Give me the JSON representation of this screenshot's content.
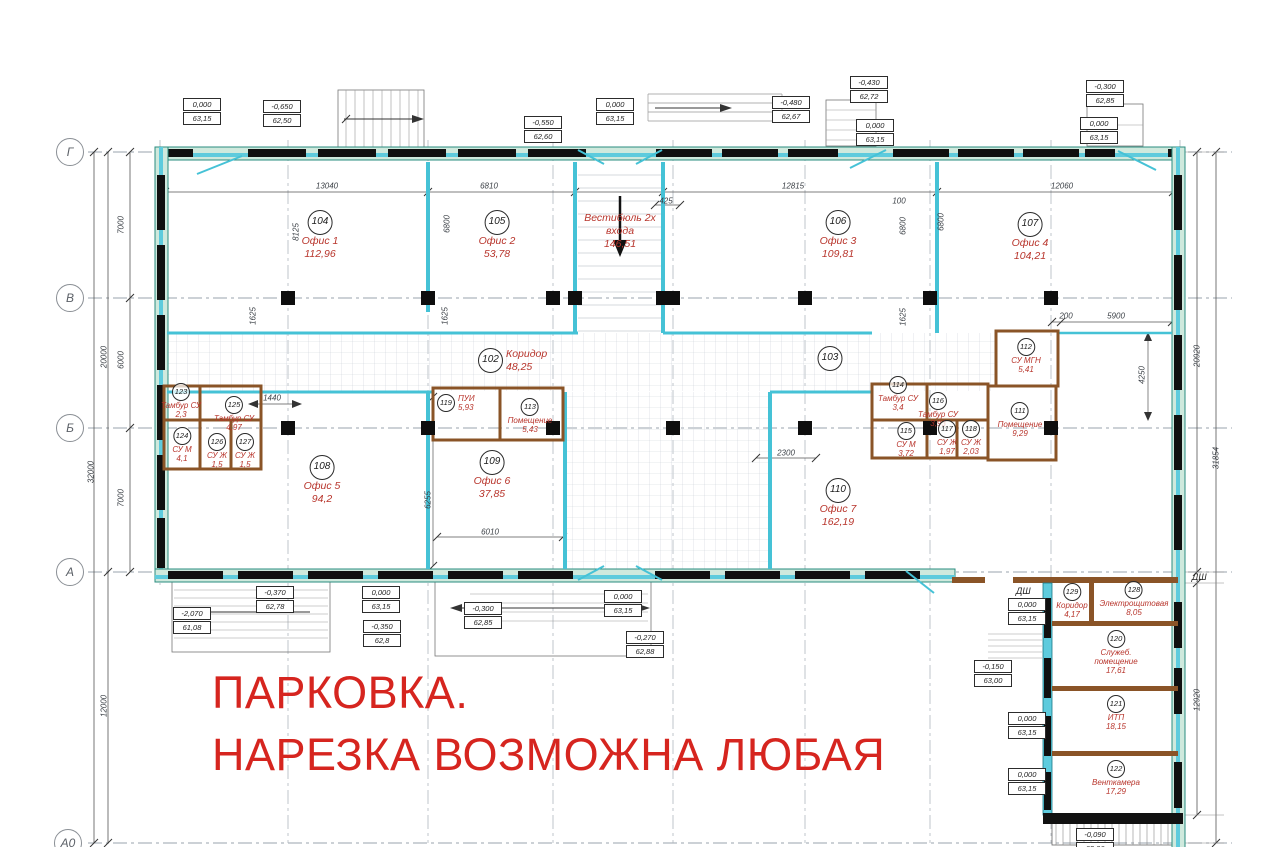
{
  "drawing": {
    "parking_note_line1": "ПАРКОВКА.",
    "parking_note_line2": "НАРЕЗКА ВОЗМОЖНА ЛЮБАЯ"
  },
  "colors": {
    "wall_cyan": "#5ecbdd",
    "wall_teal_outline": "#2a8c7f",
    "partition_brown": "#8a5427",
    "room_label_red": "#b8352c",
    "parking_red": "#d6251f"
  },
  "grid_bubbles": [
    {
      "label": "Г",
      "x": 70,
      "y": 152
    },
    {
      "label": "В",
      "x": 70,
      "y": 298
    },
    {
      "label": "Б",
      "x": 70,
      "y": 428
    },
    {
      "label": "А",
      "x": 70,
      "y": 572
    },
    {
      "label": "А0",
      "x": 68,
      "y": 843
    }
  ],
  "rooms": [
    {
      "num": "104",
      "name": "Офис 1",
      "area": "112,96",
      "x": 320,
      "y": 210,
      "size": "lg",
      "layout": "stack"
    },
    {
      "num": "105",
      "name": "Офис 2",
      "area": "53,78",
      "x": 497,
      "y": 210,
      "size": "lg",
      "layout": "stack"
    },
    {
      "num": "",
      "name": "Вестибюль 2х|входа",
      "area": "146,51",
      "x": 620,
      "y": 212,
      "size": "lg",
      "layout": "stack"
    },
    {
      "num": "106",
      "name": "Офис 3",
      "area": "109,81",
      "x": 838,
      "y": 210,
      "size": "lg",
      "layout": "stack"
    },
    {
      "num": "107",
      "name": "Офис 4",
      "area": "104,21",
      "x": 1030,
      "y": 212,
      "size": "lg",
      "layout": "stack"
    },
    {
      "num": "102",
      "name": "Коридор",
      "area": "48,25",
      "x": 478,
      "y": 348,
      "size": "lg",
      "layout": "inline"
    },
    {
      "num": "103",
      "name": "",
      "area": "",
      "x": 830,
      "y": 346,
      "size": "lg",
      "layout": "stack"
    },
    {
      "num": "108",
      "name": "Офис 5",
      "area": "94,2",
      "x": 322,
      "y": 455,
      "size": "lg",
      "layout": "stack"
    },
    {
      "num": "109",
      "name": "Офис 6",
      "area": "37,85",
      "x": 492,
      "y": 450,
      "size": "lg",
      "layout": "stack"
    },
    {
      "num": "110",
      "name": "Офис 7",
      "area": "162,19",
      "x": 838,
      "y": 478,
      "size": "lg",
      "layout": "stack"
    },
    {
      "num": "123",
      "name": "Тамбур СУ",
      "area": "2,3",
      "x": 181,
      "y": 383,
      "size": "sm",
      "layout": "stack"
    },
    {
      "num": "125",
      "name": "Тамбур СУ",
      "area": "4,97",
      "x": 234,
      "y": 396,
      "size": "sm",
      "layout": "stack"
    },
    {
      "num": "124",
      "name": "СУ М",
      "area": "4,1",
      "x": 182,
      "y": 427,
      "size": "sm",
      "layout": "stack"
    },
    {
      "num": "126",
      "name": "СУ Ж",
      "area": "1,5",
      "x": 217,
      "y": 433,
      "size": "sm",
      "layout": "stack"
    },
    {
      "num": "127",
      "name": "СУ Ж",
      "area": "1,5",
      "x": 245,
      "y": 433,
      "size": "sm",
      "layout": "stack"
    },
    {
      "num": "119",
      "name": "ПУИ",
      "area": "5,93",
      "x": 437,
      "y": 394,
      "size": "sm",
      "layout": "inline"
    },
    {
      "num": "113",
      "name": "Помещение",
      "area": "5,43",
      "x": 530,
      "y": 398,
      "size": "sm",
      "layout": "stack"
    },
    {
      "num": "114",
      "name": "Тамбур СУ",
      "area": "3,4",
      "x": 898,
      "y": 376,
      "size": "sm",
      "layout": "stack"
    },
    {
      "num": "116",
      "name": "Тамбур СУ",
      "area": "3,93",
      "x": 938,
      "y": 392,
      "size": "sm",
      "layout": "stack"
    },
    {
      "num": "112",
      "name": "СУ МГН",
      "area": "5,41",
      "x": 1026,
      "y": 338,
      "size": "sm",
      "layout": "stack"
    },
    {
      "num": "115",
      "name": "СУ М",
      "area": "3,72",
      "x": 906,
      "y": 422,
      "size": "sm",
      "layout": "stack"
    },
    {
      "num": "117",
      "name": "СУ Ж",
      "area": "1,97",
      "x": 947,
      "y": 420,
      "size": "sm",
      "layout": "stack"
    },
    {
      "num": "118",
      "name": "СУ Ж",
      "area": "2,03",
      "x": 971,
      "y": 420,
      "size": "sm",
      "layout": "stack"
    },
    {
      "num": "111",
      "name": "Помещение",
      "area": "9,29",
      "x": 1020,
      "y": 402,
      "size": "sm",
      "layout": "stack"
    },
    {
      "num": "129",
      "name": "Коридор",
      "area": "4,17",
      "x": 1072,
      "y": 583,
      "size": "sm",
      "layout": "stack"
    },
    {
      "num": "128",
      "name": "Электрощитовая",
      "area": "8,05",
      "x": 1134,
      "y": 581,
      "size": "sm",
      "layout": "stack"
    },
    {
      "num": "120",
      "name": "Служеб.|помещение",
      "area": "17,61",
      "x": 1116,
      "y": 630,
      "size": "sm",
      "layout": "stack"
    },
    {
      "num": "121",
      "name": "ИТП",
      "area": "18,15",
      "x": 1116,
      "y": 695,
      "size": "sm",
      "layout": "stack"
    },
    {
      "num": "122",
      "name": "Венткамера",
      "area": "17,29",
      "x": 1116,
      "y": 760,
      "size": "sm",
      "layout": "stack"
    }
  ],
  "elevation_marks": [
    {
      "top": "0,000",
      "bottom": "63,15",
      "x": 183,
      "y": 98
    },
    {
      "top": "-0,650",
      "bottom": "62,50",
      "x": 263,
      "y": 100
    },
    {
      "top": "-0,550",
      "bottom": "62,60",
      "x": 524,
      "y": 116
    },
    {
      "top": "0,000",
      "bottom": "63,15",
      "x": 596,
      "y": 98
    },
    {
      "top": "-0,480",
      "bottom": "62,67",
      "x": 772,
      "y": 96
    },
    {
      "top": "-0,430",
      "bottom": "62,72",
      "x": 850,
      "y": 76
    },
    {
      "top": "0,000",
      "bottom": "63,15",
      "x": 856,
      "y": 119
    },
    {
      "top": "-0,300",
      "bottom": "62,85",
      "x": 1086,
      "y": 80
    },
    {
      "top": "0,000",
      "bottom": "63,15",
      "x": 1080,
      "y": 117
    },
    {
      "top": "-2,070",
      "bottom": "61,08",
      "x": 173,
      "y": 607
    },
    {
      "top": "-0,370",
      "bottom": "62,78",
      "x": 256,
      "y": 586
    },
    {
      "top": "0,000",
      "bottom": "63,15",
      "x": 362,
      "y": 586
    },
    {
      "top": "-0,350",
      "bottom": "62,8",
      "x": 363,
      "y": 620
    },
    {
      "top": "-0,300",
      "bottom": "62,85",
      "x": 464,
      "y": 602
    },
    {
      "top": "0,000",
      "bottom": "63,15",
      "x": 604,
      "y": 590
    },
    {
      "top": "-0,270",
      "bottom": "62,88",
      "x": 626,
      "y": 631
    },
    {
      "top": "-0,150",
      "bottom": "63,00",
      "x": 974,
      "y": 660
    },
    {
      "top": "0,000",
      "bottom": "63,15",
      "x": 1008,
      "y": 598
    },
    {
      "top": "0,000",
      "bottom": "63,15",
      "x": 1008,
      "y": 712
    },
    {
      "top": "0,000",
      "bottom": "63,15",
      "x": 1008,
      "y": 768
    },
    {
      "top": "-0,090",
      "bottom": "63,06",
      "x": 1076,
      "y": 828
    }
  ],
  "dimensions": [
    {
      "text": "13040",
      "x": 327,
      "y": 186,
      "rot": 0
    },
    {
      "text": "6810",
      "x": 489,
      "y": 186,
      "rot": 0
    },
    {
      "text": "12815",
      "x": 793,
      "y": 186,
      "rot": 0
    },
    {
      "text": "12060",
      "x": 1062,
      "y": 186,
      "rot": 0
    },
    {
      "text": "425",
      "x": 666,
      "y": 201,
      "rot": 0
    },
    {
      "text": "100",
      "x": 899,
      "y": 201,
      "rot": 0
    },
    {
      "text": "8125",
      "x": 296,
      "y": 232,
      "rot": 1
    },
    {
      "text": "6800",
      "x": 447,
      "y": 224,
      "rot": 1
    },
    {
      "text": "6800",
      "x": 903,
      "y": 226,
      "rot": 1
    },
    {
      "text": "6800",
      "x": 941,
      "y": 222,
      "rot": 1
    },
    {
      "text": "1625",
      "x": 253,
      "y": 316,
      "rot": 1
    },
    {
      "text": "1625",
      "x": 445,
      "y": 316,
      "rot": 1
    },
    {
      "text": "1625",
      "x": 903,
      "y": 317,
      "rot": 1
    },
    {
      "text": "1440",
      "x": 272,
      "y": 398,
      "rot": 0
    },
    {
      "text": "6255",
      "x": 428,
      "y": 500,
      "rot": 1
    },
    {
      "text": "6010",
      "x": 490,
      "y": 532,
      "rot": 0
    },
    {
      "text": "2300",
      "x": 786,
      "y": 453,
      "rot": 0
    },
    {
      "text": "200",
      "x": 1066,
      "y": 316,
      "rot": 0
    },
    {
      "text": "5900",
      "x": 1116,
      "y": 316,
      "rot": 0
    },
    {
      "text": "4250",
      "x": 1142,
      "y": 375,
      "rot": 1
    },
    {
      "text": "7000",
      "x": 121,
      "y": 225,
      "rot": 1
    },
    {
      "text": "20000",
      "x": 104,
      "y": 357,
      "rot": 1
    },
    {
      "text": "6000",
      "x": 121,
      "y": 360,
      "rot": 1
    },
    {
      "text": "7000",
      "x": 121,
      "y": 498,
      "rot": 1
    },
    {
      "text": "32000",
      "x": 91,
      "y": 472,
      "rot": 1
    },
    {
      "text": "12000",
      "x": 104,
      "y": 706,
      "rot": 1
    },
    {
      "text": "20920",
      "x": 1197,
      "y": 356,
      "rot": 1
    },
    {
      "text": "31854",
      "x": 1216,
      "y": 458,
      "rot": 1
    },
    {
      "text": "12920",
      "x": 1197,
      "y": 700,
      "rot": 1
    }
  ],
  "annotations": [
    {
      "text": "ДШ",
      "x": 1016,
      "y": 586
    },
    {
      "text": "ДШ",
      "x": 1192,
      "y": 572
    }
  ]
}
